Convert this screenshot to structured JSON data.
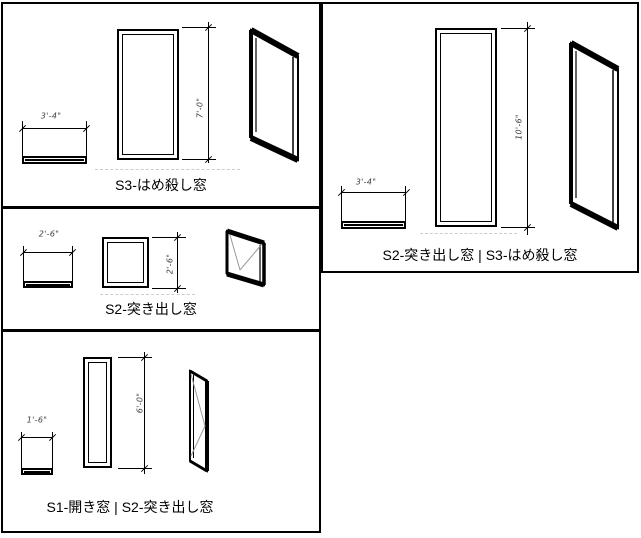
{
  "drawing": {
    "title": "window-type-legend",
    "panels": [
      {
        "label": "S3-はめ殺し窓",
        "width_dim": "3'-4\"",
        "height_dim": "7'-0\""
      },
      {
        "label": "S2-突き出し窓",
        "width_dim": "2'-6\"",
        "height_dim": "2'-6\""
      },
      {
        "label": "S1-開き窓 | S2-突き出し窓",
        "width_dim": "1'-6\"",
        "height_dim": "6'-0\""
      },
      {
        "label": "S2-突き出し窓 | S3-はめ殺し窓",
        "width_dim": "3'-4\"",
        "height_dim": "10'-6\""
      }
    ],
    "colors": {
      "line": "#000000",
      "dimension_text": "#3d3d3d",
      "sill_reference_dash": "#cccccc",
      "background": "#ffffff"
    }
  }
}
